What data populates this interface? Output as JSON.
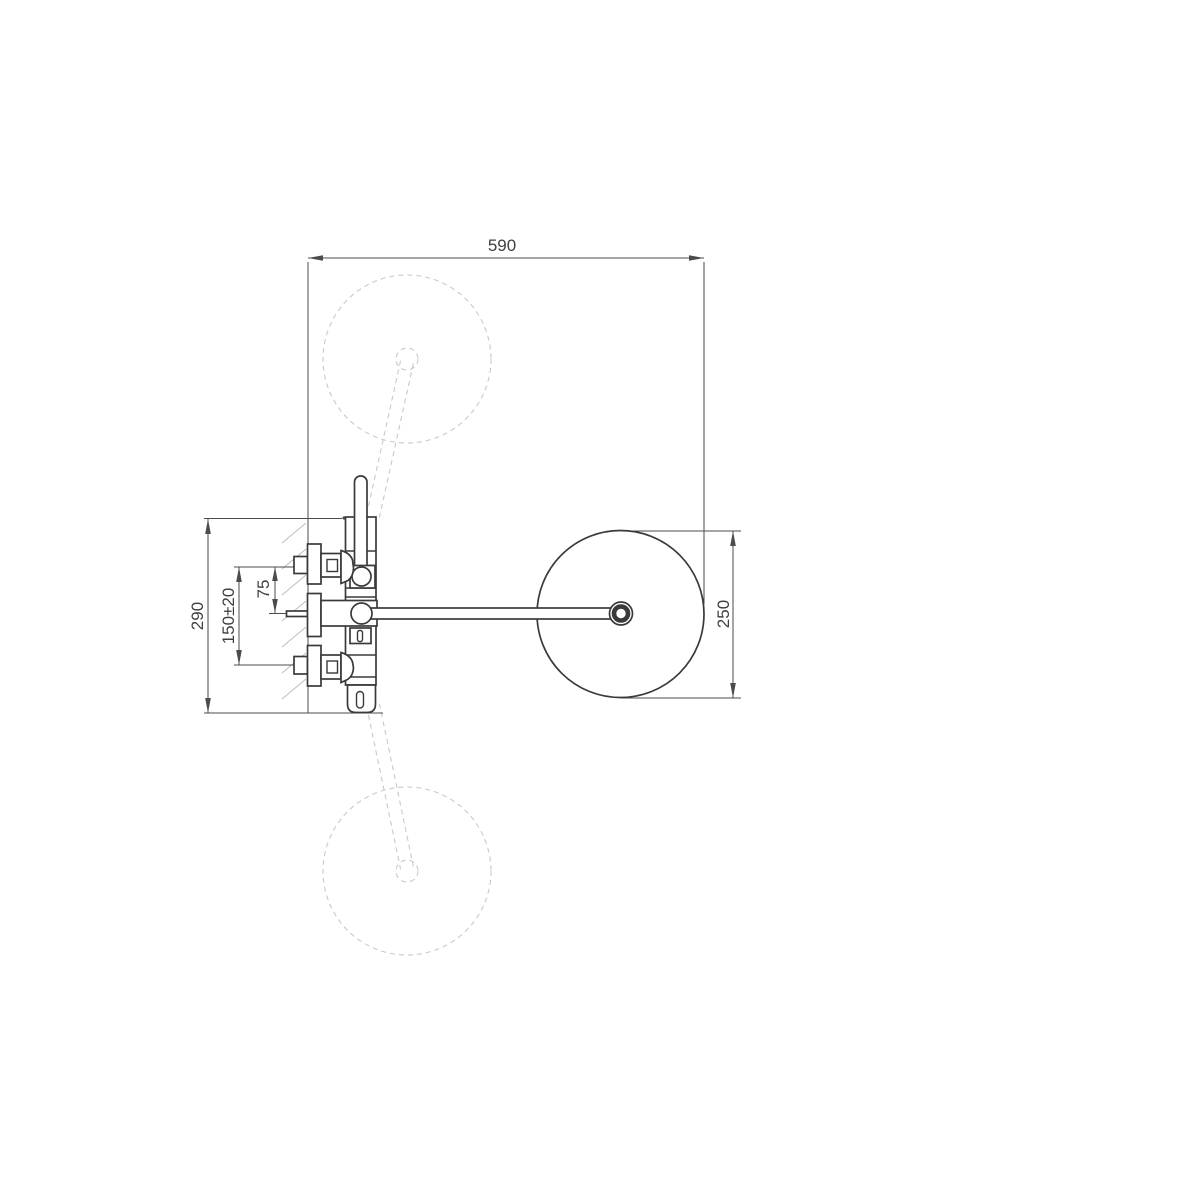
{
  "drawing": {
    "colors": {
      "background": "#ffffff",
      "line": "#3a3a3a",
      "ghost": "#c9c9c9",
      "dimension": "#4b4b4b",
      "hatch": "#bdbdbd",
      "text": "#3f3f3f"
    },
    "dimensions": {
      "width_total": {
        "label": "590"
      },
      "height_total": {
        "label": "290"
      },
      "inlet_spacing": {
        "label": "150±20"
      },
      "inlet_to_spout": {
        "label": "75"
      },
      "head_diameter": {
        "label": "250"
      }
    }
  }
}
